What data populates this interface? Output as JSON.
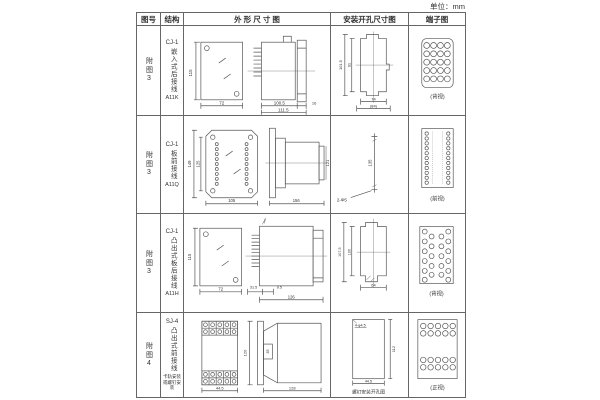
{
  "unit_label": "单位：mm",
  "headers": {
    "fig_no": "图号",
    "structure": "结构",
    "outline": "外 形 尺 寸 图",
    "mounting": "安装开孔尺寸图",
    "terminal": "端子图"
  },
  "rows": [
    {
      "fig_no": "附图3",
      "model": "CJ-1",
      "structure": "嵌入式后接线",
      "code": "A11K",
      "dims": {
        "h": "115",
        "w": "72",
        "d1": "100.5",
        "d2": "111.5",
        "d3": "16"
      },
      "mount": {
        "v1": "101.5",
        "v2": "91",
        "h1": "74",
        "h2": "(84)"
      },
      "terminal_caption": "(背视)"
    },
    {
      "fig_no": "附图3",
      "model": "CJ-1",
      "structure": "板前接线",
      "code": "A11Q",
      "dims": {
        "h1": "149",
        "h2": "125",
        "w": "105",
        "l": "156",
        "r": "121"
      },
      "mount": {
        "v1": "135",
        "hole": "2-Φ5"
      },
      "terminal_caption": "(前视)"
    },
    {
      "fig_no": "附图3",
      "model": "CJ-1",
      "structure": "凸出式板后接线",
      "code": "A11H",
      "dims": {
        "h": "115",
        "w": "72",
        "d1": "31.5",
        "d2": "9.5",
        "d3": "126"
      },
      "mount": {
        "v1": "107.5",
        "v2": "100",
        "h1": "64"
      },
      "terminal_caption": "(背视)"
    },
    {
      "fig_no": "附图4",
      "model": "SJ-4",
      "structure": "凸出式前接线",
      "note": "卡轨安装或螺钉安装",
      "dims": {
        "w": "44.5",
        "h": "120",
        "clip": "35",
        "l": "128"
      },
      "mount": {
        "hole": "4-φ4.5",
        "v1": "112",
        "h1": "44.5",
        "caption": "螺钉安装开孔图"
      },
      "terminal_caption": "(正视)"
    }
  ]
}
